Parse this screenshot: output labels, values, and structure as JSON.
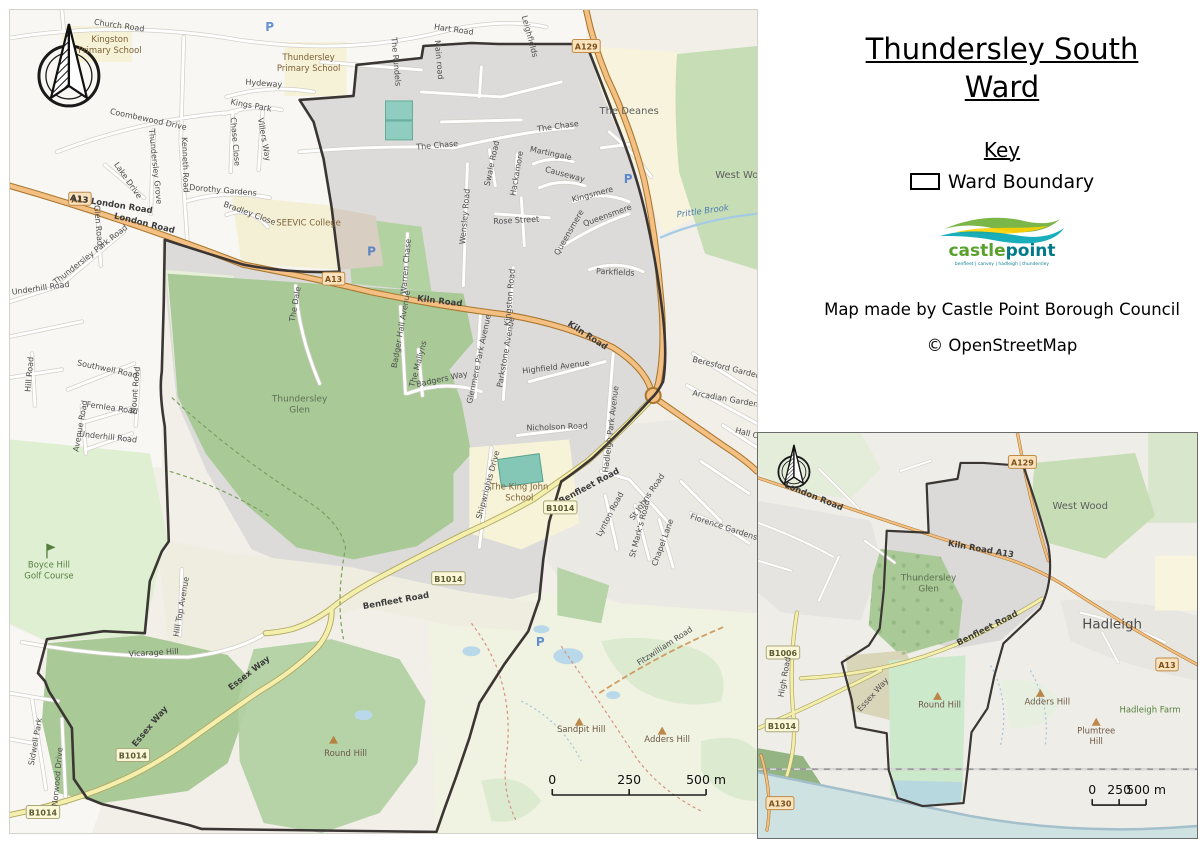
{
  "panel": {
    "title_line1": "Thundersley South",
    "title_line2": "Ward",
    "key_heading": "Key",
    "legend_label": "Ward Boundary",
    "logo_castle": "castle",
    "logo_point": "point",
    "logo_tagline": "benfleet | canvey | hadleigh | thundersley",
    "credit1": "Map made by Castle Point Borough Council",
    "credit2": "© OpenStreetMap"
  },
  "main_map": {
    "labels": [
      {
        "t": "Church Road",
        "x": 117,
        "y": 26,
        "r": 8,
        "c": "road"
      },
      {
        "t": "Kingston\nPrimary School",
        "x": 108,
        "y": 40,
        "c": "school"
      },
      {
        "t": "Thundersley\nPrimary School",
        "x": 307,
        "y": 58,
        "c": "school"
      },
      {
        "t": "Hart Road",
        "x": 452,
        "y": 30,
        "r": 8,
        "c": "road"
      },
      {
        "t": "Leighfields",
        "x": 526,
        "y": 35,
        "r": 75,
        "c": "road"
      },
      {
        "t": "The Rundels",
        "x": 392,
        "y": 60,
        "r": 85,
        "c": "road"
      },
      {
        "t": "Main road",
        "x": 435,
        "y": 58,
        "r": 85,
        "c": "road"
      },
      {
        "t": "A129",
        "x": 585,
        "y": 44,
        "c": "badge-a"
      },
      {
        "t": "The Deanes",
        "x": 628,
        "y": 112,
        "c": "place"
      },
      {
        "t": "West Wood",
        "x": 742,
        "y": 176,
        "c": "place"
      },
      {
        "t": "Prittle Brook",
        "x": 702,
        "y": 212,
        "r": -8,
        "c": "water"
      },
      {
        "t": "Hydeway",
        "x": 262,
        "y": 84,
        "r": 4,
        "c": "road"
      },
      {
        "t": "Kings Park",
        "x": 249,
        "y": 106,
        "r": 10,
        "c": "road"
      },
      {
        "t": "Villers Way",
        "x": 260,
        "y": 138,
        "r": 80,
        "c": "road"
      },
      {
        "t": "Chase Close",
        "x": 231,
        "y": 140,
        "r": 85,
        "c": "road"
      },
      {
        "t": "Coombewood Drive",
        "x": 146,
        "y": 120,
        "r": 12,
        "c": "road"
      },
      {
        "t": "Thundersley Grove",
        "x": 151,
        "y": 165,
        "r": 84,
        "c": "road"
      },
      {
        "t": "Kenneth Road",
        "x": 181,
        "y": 163,
        "r": 88,
        "c": "road"
      },
      {
        "t": "Lake Drive",
        "x": 124,
        "y": 180,
        "r": 55,
        "c": "road"
      },
      {
        "t": "Dorothy Gardens",
        "x": 221,
        "y": 191,
        "r": 5,
        "c": "road"
      },
      {
        "t": "Bradley Close",
        "x": 247,
        "y": 214,
        "r": 20,
        "c": "road"
      },
      {
        "t": "SEEVIC College",
        "x": 307,
        "y": 224,
        "c": "school"
      },
      {
        "t": "A13",
        "x": 78,
        "y": 197,
        "c": "badge-a"
      },
      {
        "t": "A13 London Road",
        "x": 109,
        "y": 205,
        "r": 9,
        "c": "road-b"
      },
      {
        "t": "London Road",
        "x": 142,
        "y": 224,
        "r": 14,
        "c": "road-b"
      },
      {
        "t": "Glen Road",
        "x": 94,
        "y": 224,
        "r": 85,
        "c": "road"
      },
      {
        "t": "Thundersley Park Road",
        "x": 90,
        "y": 255,
        "r": -38,
        "c": "road"
      },
      {
        "t": "Underhill Road",
        "x": 39,
        "y": 289,
        "r": -8,
        "c": "road"
      },
      {
        "t": "Hill Road",
        "x": 30,
        "y": 373,
        "r": -85,
        "c": "road"
      },
      {
        "t": "Southwell Road",
        "x": 105,
        "y": 370,
        "r": 12,
        "c": "road"
      },
      {
        "t": "Mount Road",
        "x": 136,
        "y": 389,
        "r": -85,
        "c": "road"
      },
      {
        "t": "Fernlea Road",
        "x": 110,
        "y": 409,
        "r": 8,
        "c": "road"
      },
      {
        "t": "Avenue Road",
        "x": 81,
        "y": 425,
        "r": -80,
        "c": "road"
      },
      {
        "t": "Underhill Road",
        "x": 106,
        "y": 438,
        "r": 6,
        "c": "road"
      },
      {
        "t": "The Chase",
        "x": 436,
        "y": 146,
        "r": -5,
        "c": "road"
      },
      {
        "t": "The Chase",
        "x": 557,
        "y": 127,
        "r": -8,
        "c": "road"
      },
      {
        "t": "Wensley Road",
        "x": 466,
        "y": 215,
        "r": -85,
        "c": "road"
      },
      {
        "t": "Swale Road",
        "x": 493,
        "y": 162,
        "r": -78,
        "c": "road"
      },
      {
        "t": "Hackamore",
        "x": 518,
        "y": 172,
        "r": -80,
        "c": "road"
      },
      {
        "t": "Martingale",
        "x": 549,
        "y": 154,
        "r": 12,
        "c": "road"
      },
      {
        "t": "Causeway",
        "x": 563,
        "y": 175,
        "r": 15,
        "c": "road"
      },
      {
        "t": "Kingsmere",
        "x": 592,
        "y": 195,
        "r": -15,
        "c": "road"
      },
      {
        "t": "Queensmere",
        "x": 607,
        "y": 216,
        "r": -20,
        "c": "road"
      },
      {
        "t": "Queensmere",
        "x": 570,
        "y": 232,
        "r": -60,
        "c": "road"
      },
      {
        "t": "Rose Street",
        "x": 515,
        "y": 221,
        "r": -3,
        "c": "road"
      },
      {
        "t": "Kingston Road",
        "x": 511,
        "y": 296,
        "r": -85,
        "c": "road"
      },
      {
        "t": "Parkfields",
        "x": 614,
        "y": 273,
        "r": 3,
        "c": "road"
      },
      {
        "t": "A13",
        "x": 332,
        "y": 277,
        "c": "badge-a"
      },
      {
        "t": "Kiln Road",
        "x": 438,
        "y": 302,
        "r": 7,
        "c": "road-b"
      },
      {
        "t": "Kiln Road",
        "x": 585,
        "y": 336,
        "r": 33,
        "c": "road-b"
      },
      {
        "t": "The Dale",
        "x": 296,
        "y": 303,
        "r": -80,
        "c": "road"
      },
      {
        "t": "Warren Chase",
        "x": 407,
        "y": 265,
        "r": -85,
        "c": "road"
      },
      {
        "t": "Badger Hall Avenue",
        "x": 402,
        "y": 328,
        "r": -80,
        "c": "road"
      },
      {
        "t": "The Mallyns",
        "x": 419,
        "y": 363,
        "r": -75,
        "c": "road"
      },
      {
        "t": "Badgers Way",
        "x": 441,
        "y": 380,
        "r": -12,
        "c": "road"
      },
      {
        "t": "Glenmere Park Avenue",
        "x": 480,
        "y": 358,
        "r": -78,
        "c": "road"
      },
      {
        "t": "Parkstone Avenue",
        "x": 507,
        "y": 351,
        "r": -80,
        "c": "road"
      },
      {
        "t": "Highfield Avenue",
        "x": 555,
        "y": 368,
        "r": -7,
        "c": "road"
      },
      {
        "t": "Thundersley\nGlen",
        "x": 298,
        "y": 400,
        "c": "wood"
      },
      {
        "t": "Nicholson Road",
        "x": 556,
        "y": 428,
        "r": -2,
        "c": "road"
      },
      {
        "t": "Hadleigh Park Avenue",
        "x": 612,
        "y": 428,
        "r": -83,
        "c": "road"
      },
      {
        "t": "Beresford Gardens",
        "x": 727,
        "y": 369,
        "r": 14,
        "c": "road"
      },
      {
        "t": "Arcadian Gardens",
        "x": 726,
        "y": 400,
        "r": 10,
        "c": "road"
      },
      {
        "t": "Hall C",
        "x": 745,
        "y": 434,
        "r": 15,
        "c": "road"
      },
      {
        "t": "The King John\nSchool",
        "x": 518,
        "y": 488,
        "c": "school"
      },
      {
        "t": "Benfleet Road",
        "x": 589,
        "y": 487,
        "r": -28,
        "c": "road-b"
      },
      {
        "t": "B1014",
        "x": 559,
        "y": 506,
        "c": "badge-b"
      },
      {
        "t": "Shipwrights Drive",
        "x": 489,
        "y": 484,
        "r": -75,
        "c": "road"
      },
      {
        "t": "St Johns Road",
        "x": 648,
        "y": 497,
        "r": -55,
        "c": "road"
      },
      {
        "t": "Lynton Road",
        "x": 611,
        "y": 514,
        "r": -62,
        "c": "road"
      },
      {
        "t": "St Mark's Road",
        "x": 641,
        "y": 528,
        "r": -75,
        "c": "road"
      },
      {
        "t": "Chapel Lane",
        "x": 664,
        "y": 542,
        "r": -70,
        "c": "road"
      },
      {
        "t": "Florence Gardens",
        "x": 722,
        "y": 528,
        "r": 18,
        "c": "road"
      },
      {
        "t": "Benfleet Road",
        "x": 395,
        "y": 602,
        "r": -10,
        "c": "road-b"
      },
      {
        "t": "B1014",
        "x": 447,
        "y": 577,
        "c": "badge-b"
      },
      {
        "t": "Vicarage Hill",
        "x": 152,
        "y": 654,
        "r": -3,
        "c": "road"
      },
      {
        "t": "Hill Top Avenue",
        "x": 182,
        "y": 606,
        "r": -80,
        "c": "road"
      },
      {
        "t": "Essex Way",
        "x": 249,
        "y": 674,
        "r": -38,
        "c": "road-b"
      },
      {
        "t": "Essex Way",
        "x": 150,
        "y": 727,
        "r": -50,
        "c": "road-b"
      },
      {
        "t": "B1014",
        "x": 131,
        "y": 754,
        "c": "badge-b"
      },
      {
        "t": "B1014",
        "x": 41,
        "y": 811,
        "c": "badge-b"
      },
      {
        "t": "Boyce Hill\nGolf Course",
        "x": 47,
        "y": 566,
        "c": "golf"
      },
      {
        "t": "Sidwell Park",
        "x": 36,
        "y": 741,
        "r": -80,
        "c": "road"
      },
      {
        "t": "Norwood Drive",
        "x": 58,
        "y": 776,
        "r": -85,
        "c": "road"
      },
      {
        "t": "Round Hill",
        "x": 344,
        "y": 755,
        "c": "hill"
      },
      {
        "t": "Sandpit Hill",
        "x": 580,
        "y": 731,
        "c": "hill"
      },
      {
        "t": "Adders Hill",
        "x": 666,
        "y": 741,
        "c": "hill"
      },
      {
        "t": "Fitzwilliam Road",
        "x": 665,
        "y": 647,
        "r": -33,
        "c": "road"
      }
    ],
    "pois": [
      {
        "ty": "p",
        "x": 268,
        "y": 29
      },
      {
        "ty": "p",
        "x": 370,
        "y": 254
      },
      {
        "ty": "p",
        "x": 627,
        "y": 181
      },
      {
        "ty": "p",
        "x": 539,
        "y": 645
      },
      {
        "ty": "peak",
        "x": 332,
        "y": 739
      },
      {
        "ty": "peak",
        "x": 578,
        "y": 721
      },
      {
        "ty": "peak",
        "x": 661,
        "y": 730
      },
      {
        "ty": "golf",
        "x": 45,
        "y": 549
      }
    ],
    "scalebar": {
      "y": 794,
      "ticks": [
        {
          "x": 551,
          "l": "0"
        },
        {
          "x": 628,
          "l": "250"
        },
        {
          "x": 705,
          "l": "500 m"
        }
      ]
    }
  },
  "inset_map": {
    "labels": [
      {
        "t": "A129",
        "x": 1022,
        "y": 461,
        "c": "badge-a"
      },
      {
        "t": "London Road",
        "x": 812,
        "y": 498,
        "r": 22,
        "c": "road-b"
      },
      {
        "t": "West Wood",
        "x": 1080,
        "y": 508,
        "c": "place"
      },
      {
        "t": "Kiln Road A13",
        "x": 980,
        "y": 551,
        "r": 10,
        "c": "road-b"
      },
      {
        "t": "Thundersley\nGlen",
        "x": 928,
        "y": 580,
        "c": "wood"
      },
      {
        "t": "Hadleigh",
        "x": 1112,
        "y": 628,
        "c": "town"
      },
      {
        "t": "Benfleet Road",
        "x": 988,
        "y": 630,
        "r": -27,
        "c": "road-b"
      },
      {
        "t": "B1006",
        "x": 782,
        "y": 652,
        "c": "badge-b"
      },
      {
        "t": "High Road",
        "x": 786,
        "y": 677,
        "r": -80,
        "c": "road"
      },
      {
        "t": "A13",
        "x": 1167,
        "y": 664,
        "c": "badge-a"
      },
      {
        "t": "Essex Way",
        "x": 874,
        "y": 696,
        "r": -48,
        "c": "road"
      },
      {
        "t": "Round Hill",
        "x": 939,
        "y": 707,
        "c": "hill"
      },
      {
        "t": "Adders Hill",
        "x": 1047,
        "y": 704,
        "c": "hill"
      },
      {
        "t": "Hadleigh Farm",
        "x": 1150,
        "y": 712,
        "c": "golf"
      },
      {
        "t": "Plumtree\nHill",
        "x": 1096,
        "y": 733,
        "c": "hill"
      },
      {
        "t": "B1014",
        "x": 781,
        "y": 725,
        "c": "badge-b"
      },
      {
        "t": "A130",
        "x": 779,
        "y": 803,
        "c": "badge-a"
      }
    ],
    "pois": [
      {
        "ty": "peak",
        "x": 937,
        "y": 696
      },
      {
        "ty": "peak",
        "x": 1040,
        "y": 693
      },
      {
        "ty": "peak",
        "x": 1096,
        "y": 722
      }
    ],
    "scalebar": {
      "y": 805,
      "ticks": [
        {
          "x": 1092,
          "l": "0"
        },
        {
          "x": 1119,
          "l": "250"
        },
        {
          "x": 1146,
          "l": "500 m"
        }
      ]
    }
  }
}
